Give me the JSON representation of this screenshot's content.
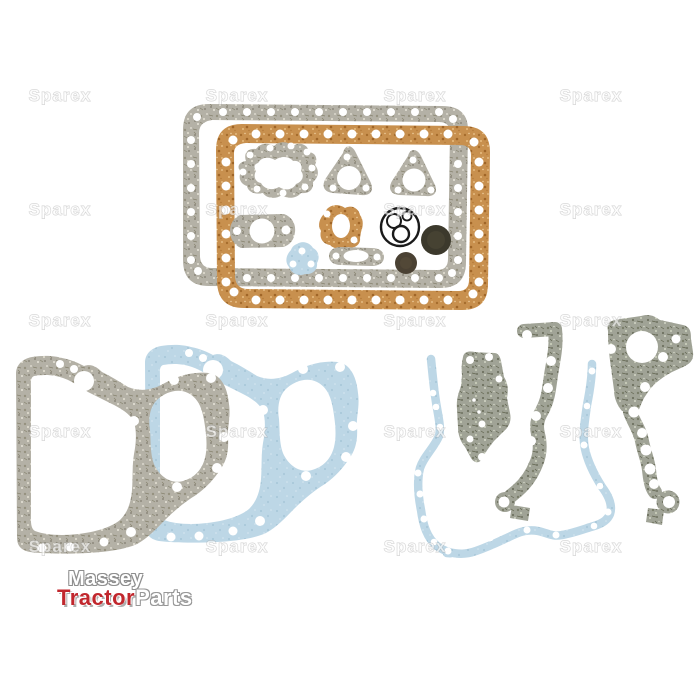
{
  "scene": {
    "background": "#ffffff",
    "description": "Product photo of a tractor engine bottom gasket set: grey and cork oil pan gaskets with small gaskets, O-rings and seals (top), and grey / blue paper front timing cover gaskets (bottom)"
  },
  "watermark": {
    "text": "Sparex",
    "fill": "rgba(255,255,255,0.6)",
    "outline": "rgba(125,125,125,0.35)"
  },
  "brand": {
    "word1": "Massey",
    "word2": "Tractor",
    "word3": "Parts",
    "word1_color": "#ffffff",
    "word2_color": "#c1272d",
    "word3_color": "#ffffff",
    "outline_color": "#8e8e8e"
  },
  "colors": {
    "gasket_gray": "#b4b1a6",
    "gasket_gray_speckle": "#8c897b",
    "gasket_olive": "#a0a396",
    "gasket_olive_speckle": "#6e7160",
    "cork": "#c8904e",
    "cork_speckle": "#a66d2d",
    "paper_blue": "#bdd7e6",
    "paper_blue_speckle": "#a6c6d8",
    "seal_large": "#3c392c",
    "seal_small": "#4a4133",
    "o_ring": "#1a1a1a",
    "bolt_hole": "#ffffff"
  },
  "parts": {
    "top_set": [
      "oil-pan-gasket-grey",
      "oil-pan-gasket-cork",
      "water-pump-gasket",
      "exhaust-flange-gasket-left",
      "exhaust-flange-gasket-right",
      "thermostat-gasket",
      "fuel-pump-gasket-cork",
      "small-blue-gasket",
      "oval-manifold-gasket",
      "o-ring-set",
      "crank-seal-large",
      "crank-seal-small"
    ],
    "bottom_left": [
      "front-cover-gasket-blue",
      "front-cover-gasket-grey"
    ],
    "bottom_right": [
      "timing-cover-gasket-blue",
      "side-plate-gasket",
      "timing-case-gasket-centre",
      "timing-case-gasket-right"
    ]
  }
}
